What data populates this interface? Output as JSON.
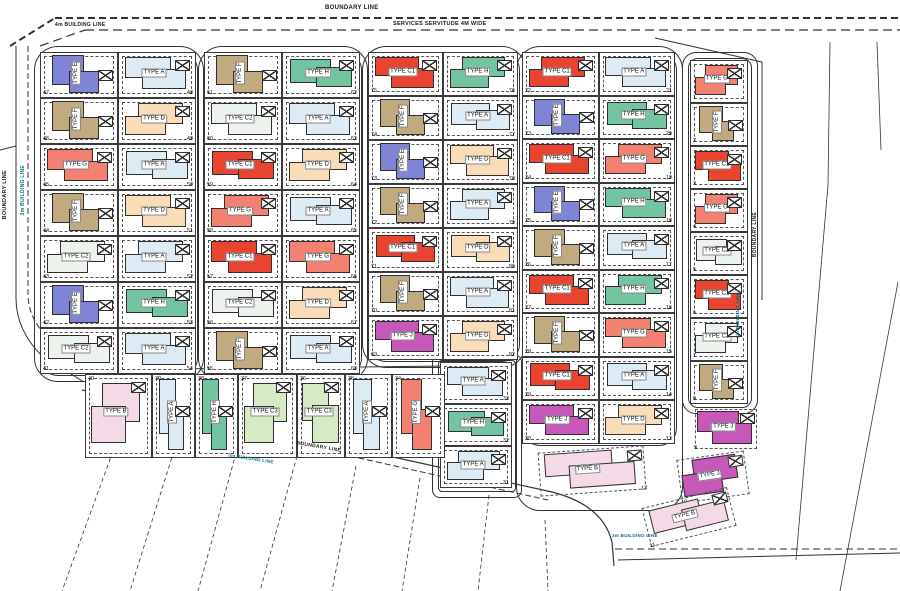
{
  "labels": {
    "boundary_line_top": "BOUNDARY LINE",
    "services_servitude": "SERVICES SERVITUDE 4M WIDE",
    "building_line_4m": "4m BUILDING LINE",
    "boundary_line_left": "BOUNDARY LINE",
    "building_line_3m_left": "3m BUILDING LINE",
    "boundary_line_bottom": "BOUNDARY LINE",
    "building_line_3m_bottom": "3m BUILDING LINE",
    "boundary_line_right": "BOUNDARY LINE",
    "building_line_3m_right": "3m BUILDING LINE",
    "building_line_3m_bottom_right": "3m BUILDING LINE"
  },
  "type_labels": {
    "A": "TYPE A",
    "B": "TYPE B",
    "C1": "TYPE C1",
    "C2": "TYPE C2",
    "C3": "TYPE C3",
    "D": "TYPE D",
    "E": "TYPE E",
    "F": "TYPE F",
    "G": "TYPE G",
    "H": "TYPE H",
    "J": "TYPE J"
  },
  "type_colors": {
    "A": "#dcebf4",
    "B": "#f4dae6",
    "C1": "#e94430",
    "C2": "#ecf2ec",
    "C3": "#d7eac6",
    "D": "#f9dcb8",
    "E": "#8084d6",
    "F": "#c2aa80",
    "G": "#f28172",
    "H": "#72c5a0",
    "J": "#c558b8"
  },
  "blocks": [
    {
      "name": "block-1",
      "left": [
        {
          "n": 47,
          "t": "E",
          "v": true
        },
        {
          "n": 46,
          "t": "F",
          "v": true
        },
        {
          "n": 45,
          "t": "G"
        },
        {
          "n": 44,
          "t": "F",
          "v": true
        },
        {
          "n": 43,
          "t": "C2"
        },
        {
          "n": 42,
          "t": "E",
          "v": true
        },
        {
          "n": 41,
          "t": "C2"
        }
      ],
      "right": [
        {
          "n": 48,
          "t": "A"
        },
        {
          "n": 49,
          "t": "D"
        },
        {
          "n": 50,
          "t": "A"
        },
        {
          "n": 51,
          "t": "D"
        },
        {
          "n": 52,
          "t": "A"
        },
        {
          "n": 53,
          "t": "H"
        },
        {
          "n": 54,
          "t": "A"
        }
      ]
    },
    {
      "name": "block-2",
      "left": [
        {
          "n": 61,
          "t": "F",
          "v": true
        },
        {
          "n": 60,
          "t": "C2"
        },
        {
          "n": 59,
          "t": "C1"
        },
        {
          "n": 58,
          "t": "G"
        },
        {
          "n": 57,
          "t": "C1"
        },
        {
          "n": 56,
          "t": "C2"
        },
        {
          "n": 55,
          "t": "F",
          "v": true
        }
      ],
      "right": [
        {
          "n": 62,
          "t": "H"
        },
        {
          "n": 63,
          "t": "A"
        },
        {
          "n": 64,
          "t": "D"
        },
        {
          "n": 65,
          "t": "A"
        },
        {
          "n": 66,
          "t": "G"
        },
        {
          "n": 67,
          "t": "D"
        },
        {
          "n": 68,
          "t": "A"
        }
      ]
    },
    {
      "name": "block-3",
      "left": [
        {
          "n": 75,
          "t": "C1"
        },
        {
          "n": 74,
          "t": "F",
          "v": true
        },
        {
          "n": 73,
          "t": "E",
          "v": true
        },
        {
          "n": 72,
          "t": "F",
          "v": true
        },
        {
          "n": 71,
          "t": "C1"
        },
        {
          "n": 70,
          "t": "F",
          "v": true
        },
        {
          "n": 69,
          "t": "J"
        }
      ],
      "right": [
        {
          "n": 76,
          "t": "H"
        },
        {
          "n": 77,
          "t": "A"
        },
        {
          "n": 78,
          "t": "D"
        },
        {
          "n": 79,
          "t": "A"
        },
        {
          "n": 80,
          "t": "D"
        },
        {
          "n": 81,
          "t": "A"
        },
        {
          "n": 82,
          "t": "D"
        }
      ]
    },
    {
      "name": "block-4",
      "left": [
        {
          "n": 22,
          "t": "C1"
        },
        {
          "n": 23,
          "t": "E",
          "v": true
        },
        {
          "n": 24,
          "t": "C1"
        },
        {
          "n": 25,
          "t": "E",
          "v": true
        },
        {
          "n": 26,
          "t": "F",
          "v": true
        },
        {
          "n": 27,
          "t": "C1"
        },
        {
          "n": 28,
          "t": "F",
          "v": true
        },
        {
          "n": 29,
          "t": "C1"
        },
        {
          "n": 30,
          "t": "J"
        }
      ],
      "right": [
        {
          "n": 21,
          "t": "A"
        },
        {
          "n": 20,
          "t": "H"
        },
        {
          "n": 19,
          "t": "G"
        },
        {
          "n": 18,
          "t": "H"
        },
        {
          "n": 17,
          "t": "A"
        },
        {
          "n": 16,
          "t": "H"
        },
        {
          "n": 15,
          "t": "G"
        },
        {
          "n": 14,
          "t": "A"
        },
        {
          "n": 13,
          "t": "D"
        }
      ]
    }
  ],
  "right_strip": [
    {
      "n": 1,
      "t": "G"
    },
    {
      "n": 2,
      "t": "F",
      "v": true
    },
    {
      "n": 3,
      "t": "C1"
    },
    {
      "n": 4,
      "t": "G"
    },
    {
      "n": 5,
      "t": "C2"
    },
    {
      "n": 6,
      "t": "C1"
    },
    {
      "n": 7,
      "t": "C2"
    },
    {
      "n": 8,
      "t": "F",
      "v": true
    }
  ],
  "stack": [
    {
      "n": 33,
      "t": "A"
    },
    {
      "n": 32,
      "t": "H"
    },
    {
      "n": 31,
      "t": "A"
    }
  ],
  "bottom_row": [
    {
      "n": 40,
      "t": "B"
    },
    {
      "n": 39,
      "t": "A",
      "v": true
    },
    {
      "n": 38,
      "t": "H",
      "v": true
    },
    {
      "n": 37,
      "t": "C3"
    },
    {
      "n": 36,
      "t": "C3"
    },
    {
      "n": 35,
      "t": "A",
      "v": true
    },
    {
      "n": 34,
      "t": "G",
      "v": true
    }
  ],
  "outparcels": [
    {
      "n": 9,
      "t": "J"
    },
    {
      "n": 10,
      "t": "J"
    },
    {
      "n": 11,
      "t": "B"
    },
    {
      "n": 12,
      "t": "B"
    }
  ]
}
